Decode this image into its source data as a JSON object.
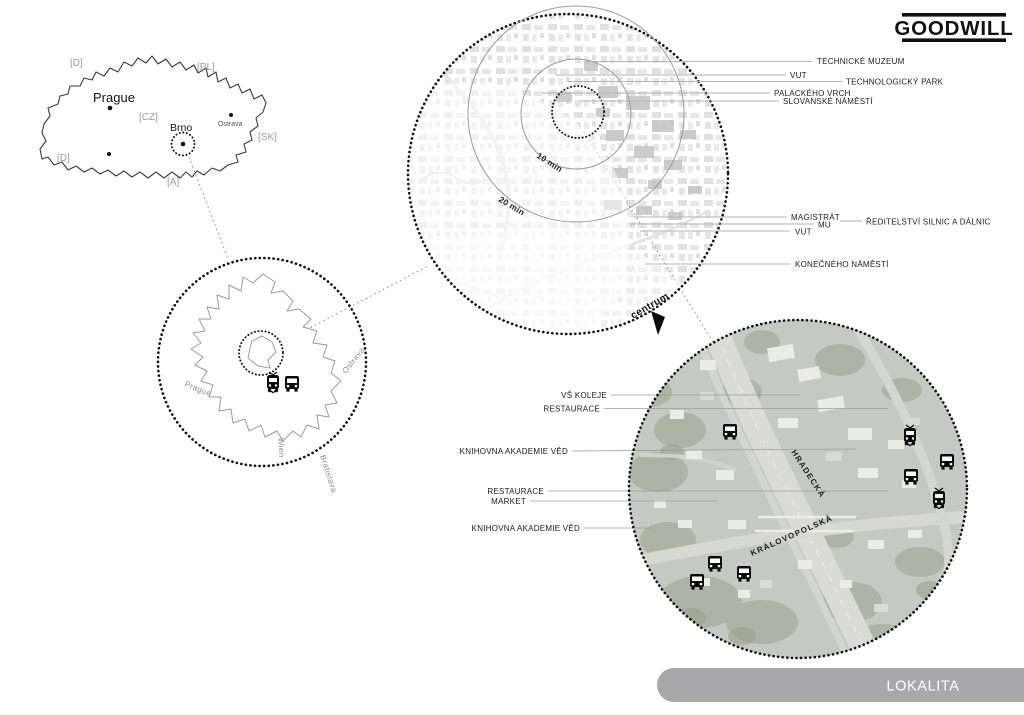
{
  "logo": {
    "text": "GOODWILL"
  },
  "banner": {
    "label": "LOKALITA"
  },
  "colors": {
    "banner_bg": "#a8a8ab",
    "banner_text": "#ffffff",
    "label_gray": "#9a9a9a",
    "ink": "#1a1a1a",
    "leader_line": "#b3b3b3",
    "satellite_base": "#c6c9c1"
  },
  "country_map": {
    "labels": {
      "d_top": "[D]",
      "pl": "[PL]",
      "cz": "[CZ]",
      "sk": "[SK]",
      "a": "[A]",
      "d_bottom": "[D]"
    },
    "cities": {
      "prague": "Prague",
      "brno": "Brno",
      "ostrava": "Ostrava"
    }
  },
  "brno_map": {
    "directions": {
      "prague": "Prague",
      "ostrava": "Ostrava",
      "wien": "Wien",
      "bratislava": "Bratislava"
    },
    "icons": [
      "tram-icon",
      "bus-icon"
    ]
  },
  "city_map": {
    "rings": {
      "inner": "10 min",
      "outer": "20 min"
    },
    "centrum": "centrum",
    "callouts": [
      {
        "label": "TECHNICKÉ MUZEUM"
      },
      {
        "label": "VUT"
      },
      {
        "label": "TECHNOLOGICKÝ PARK"
      },
      {
        "label": "PALACKÉHO VRCH"
      },
      {
        "label": "SLOVANSKÉ NÁMĚSTÍ"
      },
      {
        "label": "MAGISTRÁT"
      },
      {
        "label": "ŘEDITELSTVÍ SILNIC A DÁLNIC"
      },
      {
        "label": "MU"
      },
      {
        "label": "VUT"
      },
      {
        "label": "KONEČNÉHO NÁMĚSTÍ"
      }
    ]
  },
  "satellite": {
    "streets": {
      "hradecka": "HRADECKÁ",
      "kralovopolska": "KRÁLOVOPOLSKÁ"
    },
    "callouts": [
      {
        "label": "VŠ KOLEJE"
      },
      {
        "label": "RESTAURACE"
      },
      {
        "label": "KNIHOVNA AKADEMIE VĚD"
      },
      {
        "label": "RESTAURACE"
      },
      {
        "label": "MARKET"
      },
      {
        "label": "KNIHOVNA AKADEMIE VĚD"
      }
    ],
    "icons": [
      "bus-icon",
      "tram-icon"
    ]
  }
}
